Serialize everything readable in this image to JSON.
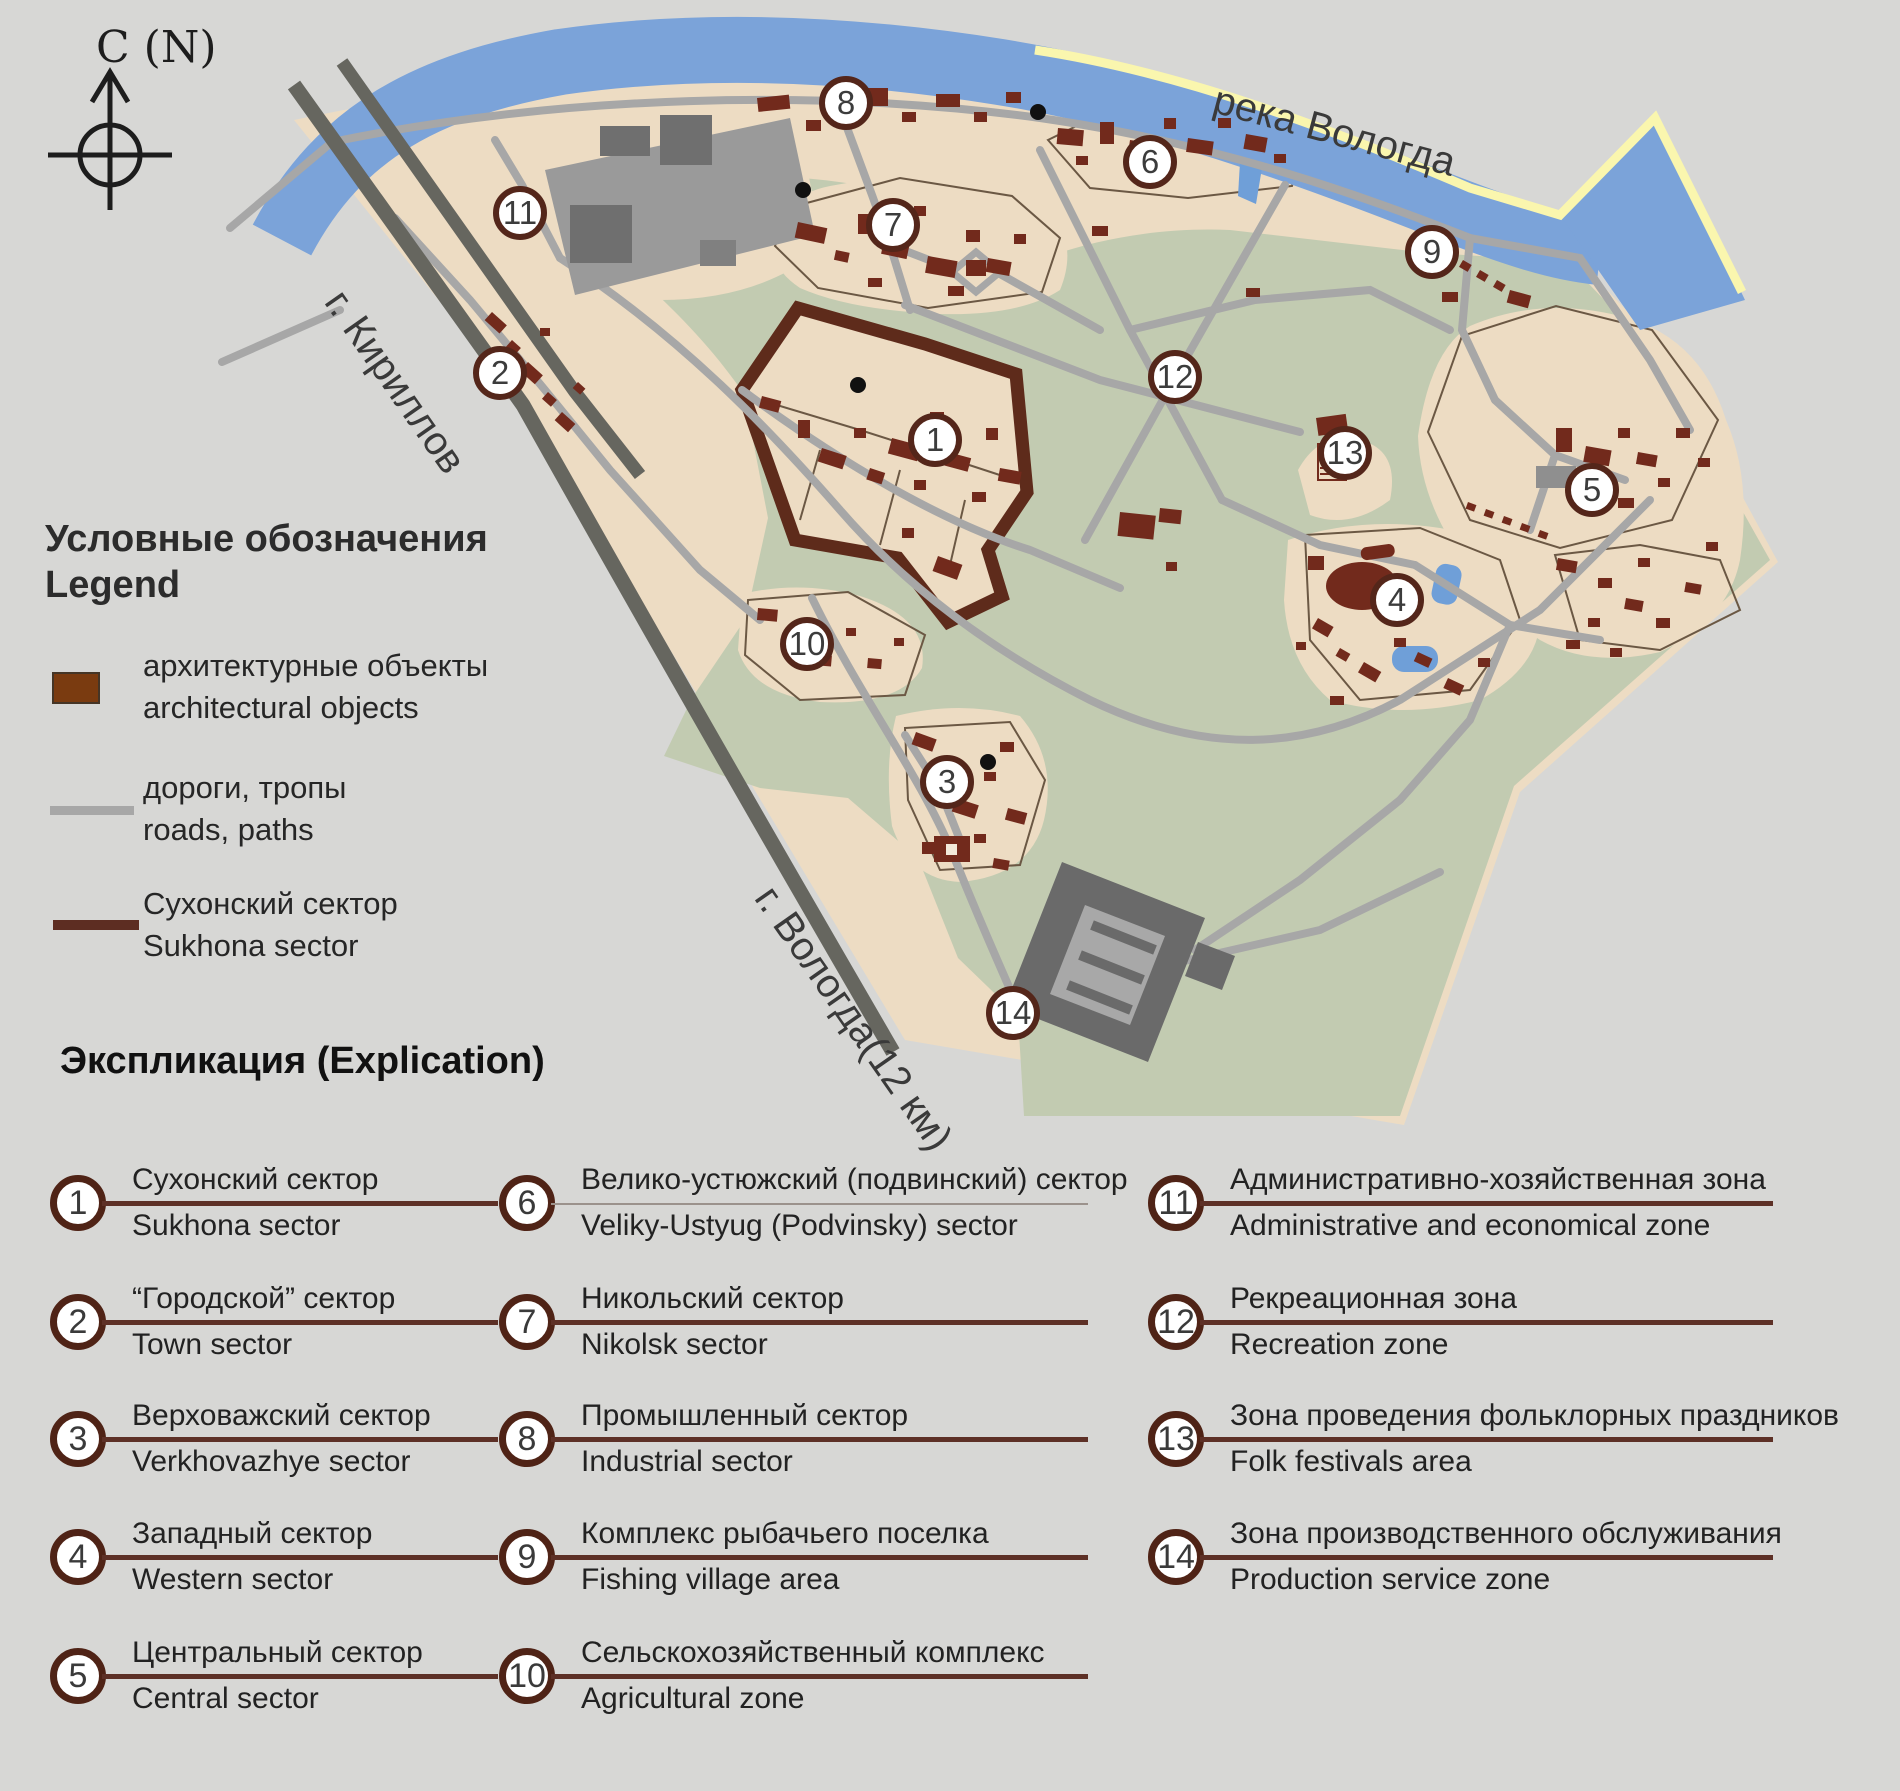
{
  "compass_label": "С (N)",
  "map": {
    "labels": {
      "river": "река Вологда",
      "road_kirillov": "г. Кириллов",
      "road_vologda": "г. Вологда(12 км)"
    },
    "markers": [
      "1",
      "2",
      "3",
      "4",
      "5",
      "6",
      "7",
      "8",
      "9",
      "10",
      "11",
      "12",
      "13",
      "14"
    ]
  },
  "legend": {
    "title_ru": "Условные обозначения",
    "title_en": "Legend",
    "items": [
      {
        "ru": "архитектурные объекты",
        "en": "architectural objects"
      },
      {
        "ru": "дороги, тропы",
        "en": "roads, paths"
      },
      {
        "ru": "Сухонский сектор",
        "en": "Sukhona sector"
      }
    ]
  },
  "explication": {
    "title": "Экспликация (Explication)",
    "items": [
      {
        "num": "1",
        "ru": "Сухонский сектор",
        "en": "Sukhona sector"
      },
      {
        "num": "2",
        "ru": "“Городской” сектор",
        "en": "Town sector"
      },
      {
        "num": "3",
        "ru": "Верховажский сектор",
        "en": "Verkhovazhye sector"
      },
      {
        "num": "4",
        "ru": "Западный сектор",
        "en": "Western sector"
      },
      {
        "num": "5",
        "ru": "Центральный сектор",
        "en": "Central sector"
      },
      {
        "num": "6",
        "ru": "Велико-устюжский (подвинский) сектор",
        "en": "Veliky-Ustyug (Podvinsky) sector"
      },
      {
        "num": "7",
        "ru": "Никольский сектор",
        "en": "Nikolsk sector"
      },
      {
        "num": "8",
        "ru": "Промышленный сектор",
        "en": "Industrial sector"
      },
      {
        "num": "9",
        "ru": "Комплекс рыбачьего поселка",
        "en": "Fishing village area"
      },
      {
        "num": "10",
        "ru": "Сельскохозяйственный комплекс",
        "en": "Agricultural zone"
      },
      {
        "num": "11",
        "ru": "Административно-хозяйственная зона",
        "en": "Administrative and economical zone"
      },
      {
        "num": "12",
        "ru": "Рекреационная зона",
        "en": "Recreation zone"
      },
      {
        "num": "13",
        "ru": "Зона проведения фольклорных праздников",
        "en": "Folk festivals area"
      },
      {
        "num": "14",
        "ru": "Зона производственного обслуживания",
        "en": "Production service zone"
      }
    ]
  },
  "colors": {
    "page_bg": "#d7d7d5",
    "land": "#eddcc3",
    "greenery": "#c2cbb1",
    "river": "#7ba3d9",
    "shore_line": "#faf6ae",
    "road": "#a7a7a7",
    "dark_road": "#66665f",
    "building": "#722a1c",
    "sector_outline": "#5e2b1b",
    "marker_border": "#54261a"
  }
}
